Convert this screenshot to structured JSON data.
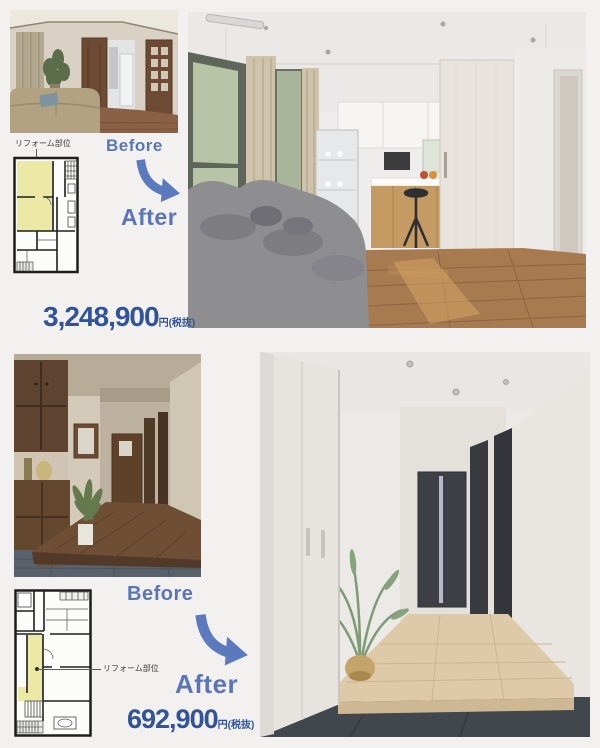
{
  "page": {
    "type": "renovation-brochure",
    "background_color": "#f2f1ef"
  },
  "colors": {
    "accent_blue": "#5b76b8",
    "price_blue": "#31539b",
    "plan_highlight_yellow": "#ece9a6",
    "plan_line": "#1e1e1e"
  },
  "icons": {
    "before_after_arrow": "curved-arrow-down-right"
  },
  "sections": [
    {
      "id": "ldk-renovation",
      "plan_label": "リフォーム部位",
      "before_label": "Before",
      "after_label": "After",
      "price_value": "3,248,900",
      "price_unit": "円(税抜)"
    },
    {
      "id": "entrance-renovation",
      "plan_label": "リフォーム部位",
      "before_label": "Before",
      "after_label": "After",
      "price_value": "692,900",
      "price_unit": "円(税抜)"
    }
  ]
}
